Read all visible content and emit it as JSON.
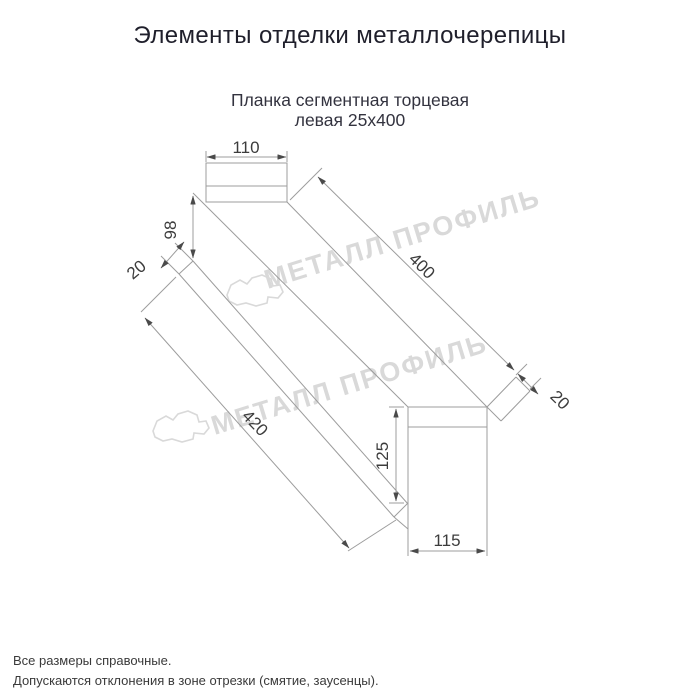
{
  "title": "Элементы отделки металлочерепицы",
  "subtitle": {
    "line1": "Планка сегментная торцевая",
    "line2": "левая 25х400"
  },
  "dimensions": {
    "flange_width_top": "110",
    "left_end_height": "98",
    "left_hem": "20",
    "top_edge_length": "400",
    "bottom_edge_length": "420",
    "right_hem": "20",
    "right_end_height": "125",
    "flange_width_bottom": "115"
  },
  "watermark": {
    "text": "МЕТАЛЛ ПРОФИЛЬ"
  },
  "footnotes": [
    "Все размеры справочные.",
    "Допускаются отклонения в зоне отрезки (смятие, заусенцы)."
  ],
  "colors": {
    "background": "#ffffff",
    "title_text": "#1f1f2b",
    "subtitle_text": "#33333f",
    "dimension_text": "#3c3c3c",
    "line": "#9c9c9c",
    "arrow": "#4a4a4a",
    "watermark": "#d9d9d9",
    "footnote_text": "#3a3a3a"
  }
}
